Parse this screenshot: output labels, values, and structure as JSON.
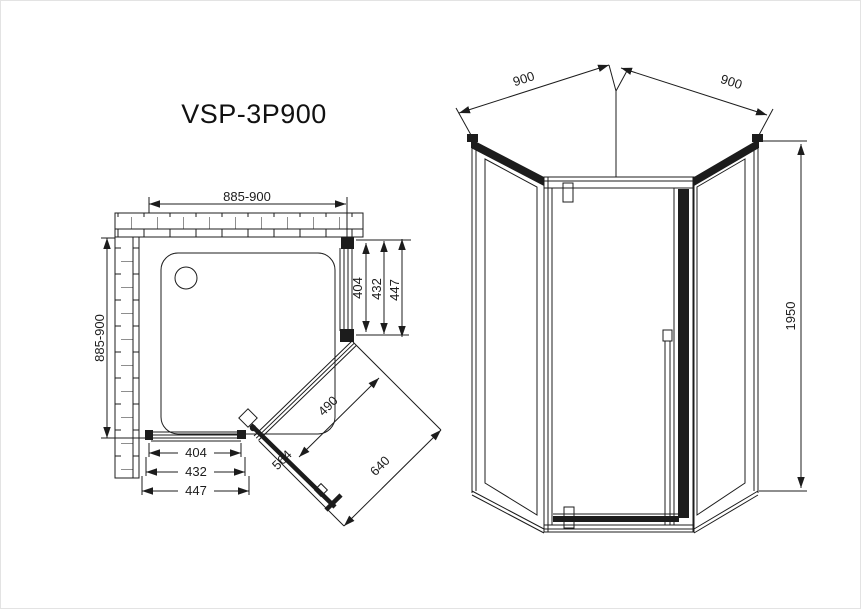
{
  "title": "VSP-3P900",
  "colors": {
    "line": "#1c1c1c",
    "background": "#ffffff"
  },
  "plan_view": {
    "label": "top-plan-view",
    "dim_width_top": "885-900",
    "dim_depth_left": "885-900",
    "dims_right": [
      "404",
      "432",
      "447"
    ],
    "dims_bottom": [
      "404",
      "432",
      "447"
    ],
    "dim_door_glass": "490",
    "dim_door_panel": "564",
    "dim_diag_opening": "640"
  },
  "front_view": {
    "label": "front-elevation-view",
    "dim_side_left": "900",
    "dim_side_right": "900",
    "dim_height": "1950"
  }
}
